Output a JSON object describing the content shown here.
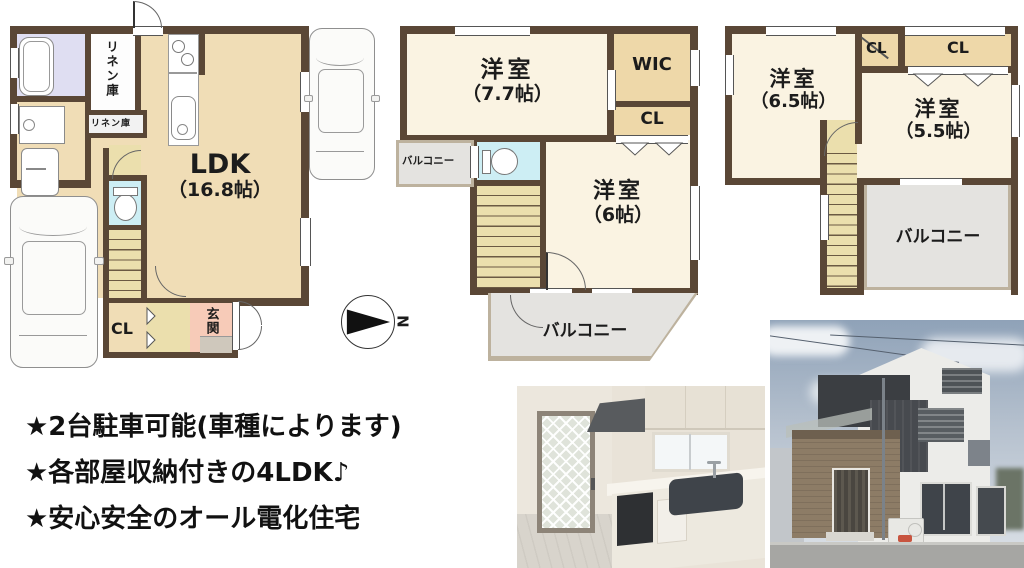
{
  "document": {
    "type": "real-estate-floorplan-flyer",
    "background": "#ffffff"
  },
  "colors": {
    "wall": "#5a4736",
    "ldk_floor": "#f0ddb6",
    "room_floor": "#faf3e2",
    "hall_stairs_floor": "#ebdfad",
    "closet_floor": "#eed8a9",
    "toilet_floor": "#cdeef4",
    "bath_floor": "#dfdef2",
    "genkan_floor": "#f7cbb8",
    "balcony_floor": "#e4e3e0",
    "balcony_border": "#bdb29e"
  },
  "floor1": {
    "ldk_label": "LDK",
    "ldk_size": "（16.8帖）",
    "linen_label": "リネン庫",
    "linen2_label": "リネン庫",
    "cl_label": "CL",
    "genkan_label": "玄関"
  },
  "floor2": {
    "room1_label": "洋室",
    "room1_size": "（7.7帖）",
    "wic_label": "WIC",
    "cl_label": "CL",
    "room2_label": "洋室",
    "room2_size": "（6帖）",
    "balcony_left_label": "バルコニー",
    "balcony_label": "バルコニー"
  },
  "floor3": {
    "room1_label": "洋室",
    "room1_size": "（6.5帖）",
    "cl1_label": "CL",
    "cl2_label": "CL",
    "room2_label": "洋室",
    "room2_size": "（5.5帖）",
    "balcony_label": "バルコニー"
  },
  "compass": {
    "north_label": "N"
  },
  "features": {
    "line1": "★2台駐車可能(車種によります)",
    "line2": "★各部屋収納付きの4LDK♪",
    "line3": "★安心安全のオール電化住宅"
  }
}
